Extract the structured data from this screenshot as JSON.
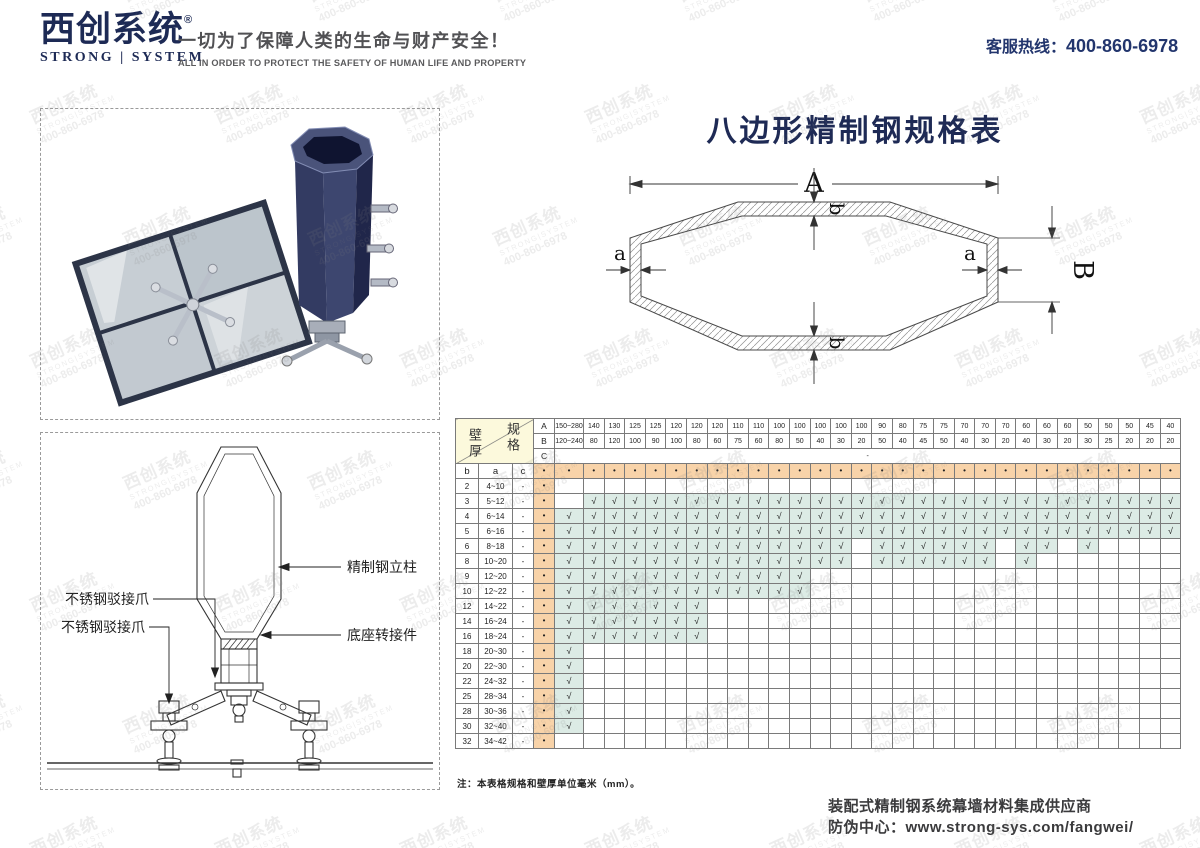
{
  "header": {
    "logo_cn": "西创系统",
    "logo_reg": "®",
    "logo_en": "STRONG | SYSTEM",
    "tagline_cn": "一切为了保障人类的生命与财产安全！",
    "tagline_en": "ALL IN ORDER TO PROTECT THE SAFETY OF HUMAN LIFE AND PROPERTY",
    "hotline_label": "客服热线：",
    "hotline_number": "400-860-6978"
  },
  "watermark": {
    "line1": "西创系统",
    "line2": "STRONG|SYSTEM",
    "line3": "400-860-6978"
  },
  "left_panels": {
    "drawing_labels": {
      "column": "精制钢立柱",
      "spider_upper": "不锈钢驳接爪",
      "spider_lower": "不锈钢驳接爪",
      "base": "底座转接件"
    }
  },
  "main": {
    "title": "八边形精制钢规格表",
    "dims": {
      "A": "A",
      "B": "B",
      "a": "a",
      "b": "b"
    },
    "note": "注：本表格规格和壁厚单位毫米（mm）。",
    "footer_line1": "装配式精制钢系统幕墙材料集成供应商",
    "footer_line2": "防伪中心：www.strong-sys.com/fangwei/"
  },
  "table": {
    "corner_top": "规格",
    "corner_bottom": "壁厚",
    "spec_row_labels": [
      "A",
      "B",
      "C"
    ],
    "c_row_value": "-",
    "thickness_headers": [
      "b",
      "a",
      "c"
    ],
    "bullet": "•",
    "check_glyph": "√",
    "columns": [
      {
        "A": "150~280",
        "B": "120~240"
      },
      {
        "A": "140",
        "B": "80"
      },
      {
        "A": "130",
        "B": "120"
      },
      {
        "A": "125",
        "B": "100"
      },
      {
        "A": "125",
        "B": "90"
      },
      {
        "A": "120",
        "B": "100"
      },
      {
        "A": "120",
        "B": "80"
      },
      {
        "A": "120",
        "B": "60"
      },
      {
        "A": "110",
        "B": "75"
      },
      {
        "A": "110",
        "B": "60"
      },
      {
        "A": "100",
        "B": "80"
      },
      {
        "A": "100",
        "B": "50"
      },
      {
        "A": "100",
        "B": "40"
      },
      {
        "A": "100",
        "B": "30"
      },
      {
        "A": "100",
        "B": "20"
      },
      {
        "A": "90",
        "B": "50"
      },
      {
        "A": "80",
        "B": "40"
      },
      {
        "A": "75",
        "B": "45"
      },
      {
        "A": "75",
        "B": "50"
      },
      {
        "A": "70",
        "B": "40"
      },
      {
        "A": "70",
        "B": "30"
      },
      {
        "A": "70",
        "B": "20"
      },
      {
        "A": "60",
        "B": "40"
      },
      {
        "A": "60",
        "B": "30"
      },
      {
        "A": "60",
        "B": "20"
      },
      {
        "A": "50",
        "B": "30"
      },
      {
        "A": "50",
        "B": "25"
      },
      {
        "A": "50",
        "B": "20"
      },
      {
        "A": "45",
        "B": "20"
      },
      {
        "A": "40",
        "B": "20"
      }
    ],
    "rows": [
      {
        "b": "2",
        "a": "4~10",
        "c": "-",
        "checks": "000000000000000000000000000000"
      },
      {
        "b": "3",
        "a": "5~12",
        "c": "-",
        "checks": "011111111111111111111111111111"
      },
      {
        "b": "4",
        "a": "6~14",
        "c": "-",
        "checks": "111111111111111111111111111111"
      },
      {
        "b": "5",
        "a": "6~16",
        "c": "-",
        "checks": "111111111111111111111111111111"
      },
      {
        "b": "6",
        "a": "8~18",
        "c": "-",
        "checks": "111111111111110111111011010000"
      },
      {
        "b": "8",
        "a": "10~20",
        "c": "-",
        "checks": "111111111111110111111010000000"
      },
      {
        "b": "9",
        "a": "12~20",
        "c": "-",
        "checks": "111111111111000000000000000000"
      },
      {
        "b": "10",
        "a": "12~22",
        "c": "-",
        "checks": "111111111111000000000000000000"
      },
      {
        "b": "12",
        "a": "14~22",
        "c": "-",
        "checks": "111111100000000000000000000000"
      },
      {
        "b": "14",
        "a": "16~24",
        "c": "-",
        "checks": "111111100000000000000000000000"
      },
      {
        "b": "16",
        "a": "18~24",
        "c": "-",
        "checks": "111111100000000000000000000000"
      },
      {
        "b": "18",
        "a": "20~30",
        "c": "-",
        "checks": "100000000000000000000000000000"
      },
      {
        "b": "20",
        "a": "22~30",
        "c": "-",
        "checks": "100000000000000000000000000000"
      },
      {
        "b": "22",
        "a": "24~32",
        "c": "-",
        "checks": "100000000000000000000000000000"
      },
      {
        "b": "25",
        "a": "28~34",
        "c": "-",
        "checks": "100000000000000000000000000000"
      },
      {
        "b": "28",
        "a": "30~36",
        "c": "-",
        "checks": "100000000000000000000000000000"
      },
      {
        "b": "30",
        "a": "32~40",
        "c": "-",
        "checks": "100000000000000000000000000000"
      },
      {
        "b": "32",
        "a": "34~42",
        "c": "-",
        "checks": "000000000000000000000000000000"
      }
    ]
  }
}
